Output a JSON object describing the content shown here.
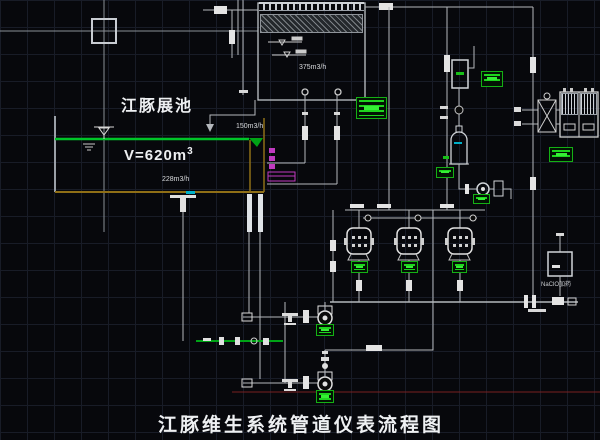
{
  "drawing": {
    "title": "江豚维生系统管道仪表流程图",
    "pool": {
      "name": "江豚展池",
      "volume_prefix": "V=620m",
      "volume_exponent": "3",
      "bottom_outflow": "228m3/h",
      "overflow_outflow": "150m3/h"
    },
    "gravity_filter": {
      "flow": "375m3/h"
    },
    "dosing": {
      "label": "NaClO加药"
    },
    "colors": {
      "background": "#07080c",
      "grid": "#181c27",
      "pipe": "#b4b8bc",
      "fitting": "#e4e4e4",
      "tank_olive": "#8f6f16",
      "water_green": "#00c428",
      "return_green": "#00a316",
      "tag_green": "#1ed41e",
      "magenta": "#c03ac0",
      "cyan": "#00b0c8",
      "datum_red": "#7a2020"
    }
  }
}
